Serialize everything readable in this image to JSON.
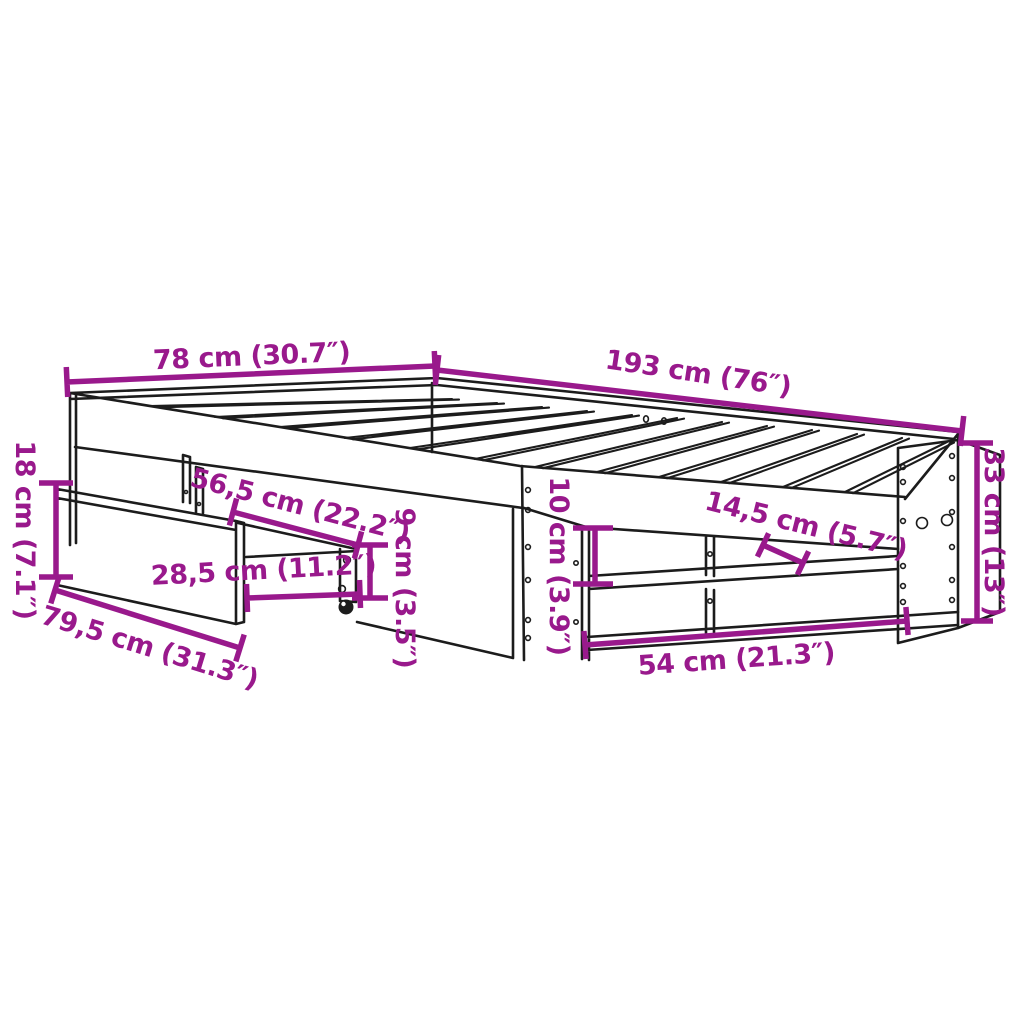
{
  "diagram": {
    "type": "product-dimension-diagram",
    "subject": "bed-frame-with-drawer-and-shelf",
    "colors": {
      "dimension_accent": "#99198C",
      "outline_ink": "#1c1c1c",
      "background": "#ffffff"
    },
    "dimensions": [
      {
        "id": "head-width",
        "label": "78 cm (30.7″)"
      },
      {
        "id": "frame-length",
        "label": "193 cm (76″)"
      },
      {
        "id": "frame-height",
        "label": "33 cm (13″)"
      },
      {
        "id": "underbed-clearance",
        "label": "18 cm (7.1″)"
      },
      {
        "id": "drawer-depth",
        "label": "56,5 cm (22.2″)"
      },
      {
        "id": "drawer-pullout",
        "label": "28,5 cm (11.2″)"
      },
      {
        "id": "drawer-width",
        "label": "79,5 cm (31.3″)"
      },
      {
        "id": "drawer-height",
        "label": "9 cm (3.5″)"
      },
      {
        "id": "shelf-opening-height",
        "label": "10 cm (3.9″)"
      },
      {
        "id": "shelf-depth",
        "label": "14,5 cm (5.7″)"
      },
      {
        "id": "shelf-width",
        "label": "54 cm (21.3″)"
      }
    ]
  }
}
